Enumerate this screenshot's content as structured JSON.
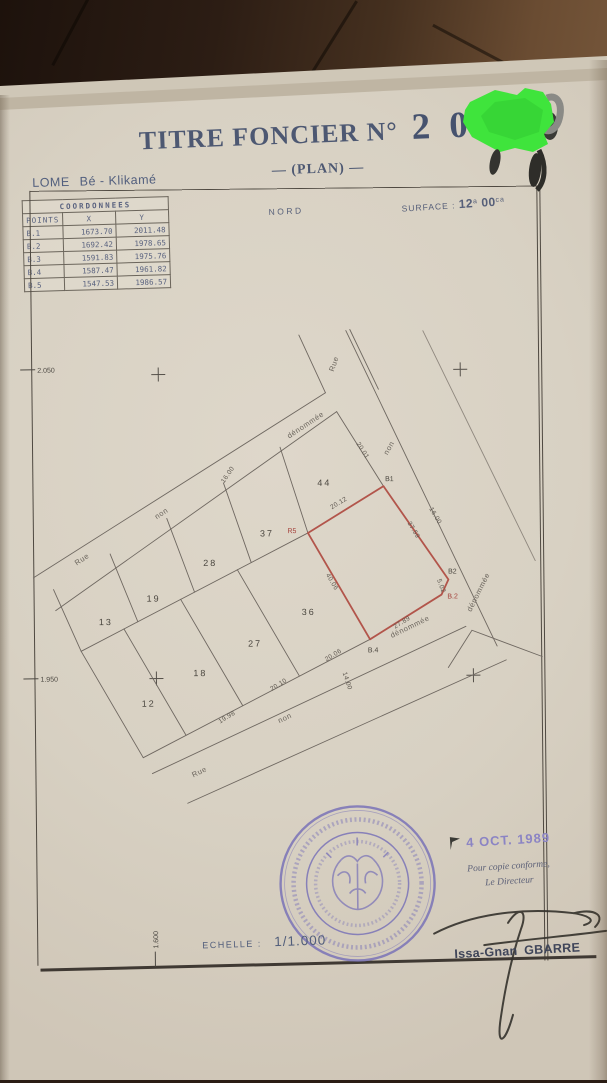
{
  "document": {
    "title_label": "TITRE FONCIER N°",
    "title_number": "2 0",
    "subtitle": "— (PLAN) —",
    "location_city": "LOME",
    "location_area": "Bé - Klikamé",
    "north_label": "NORD",
    "surface": {
      "label": "SURFACE :",
      "ares": "12",
      "ares_unit": "a",
      "centiares": "00",
      "centiares_unit": "ca"
    },
    "coordinates_table": {
      "title": "COORDONNEES",
      "columns": [
        "POINTS",
        "X",
        "Y"
      ],
      "rows": [
        {
          "point": "B.1",
          "x": "1673.70",
          "y": "2011.48"
        },
        {
          "point": "B.2",
          "x": "1692.42",
          "y": "1978.65"
        },
        {
          "point": "B.3",
          "x": "1591.83",
          "y": "1975.76"
        },
        {
          "point": "B.4",
          "x": "1587.47",
          "y": "1961.82"
        },
        {
          "point": "B.5",
          "x": "1547.53",
          "y": "1986.57"
        }
      ]
    },
    "plan": {
      "parcel_numbers": {
        "p13": "13",
        "p19": "19",
        "p28": "28",
        "p37": "37",
        "p44": "44",
        "p12": "12",
        "p18": "18",
        "p27": "27",
        "p36": "36"
      },
      "corner_points": {
        "b1": "B1",
        "r5": "R5",
        "b2": "B2",
        "b2b": "B.2",
        "b4": "B.4"
      },
      "measurements": {
        "e2001": "20.01",
        "e2012": "20.12",
        "e3759": "37.59",
        "e1600r": "16.00",
        "e4006": "40.06",
        "e2789": "27.89",
        "e502": "5.02",
        "e2006": "20.06",
        "e1400": "14.00",
        "e2010": "20.10",
        "e1998": "19.98",
        "e1600t": "16.00"
      },
      "streets": {
        "rue1": "Rue",
        "non1": "non",
        "den1": "dénommée",
        "rue2": "Rue",
        "non2": "non",
        "den2": "dénommée",
        "rue3": "Rue",
        "non3": "non",
        "den3": "dénommée"
      },
      "grid_refs": {
        "y_top": "2.050",
        "y_bottom": "1.950",
        "x_left": "1.600"
      }
    },
    "certification": {
      "date_stamp": "4 OCT. 1989",
      "copy_line1": "Pour copie conforme,",
      "copy_line2": "Le Directeur",
      "signatory": "Issa-Gnan GBARRE"
    },
    "scale": {
      "label": "ECHELLE :",
      "value": "1/1.000"
    }
  }
}
